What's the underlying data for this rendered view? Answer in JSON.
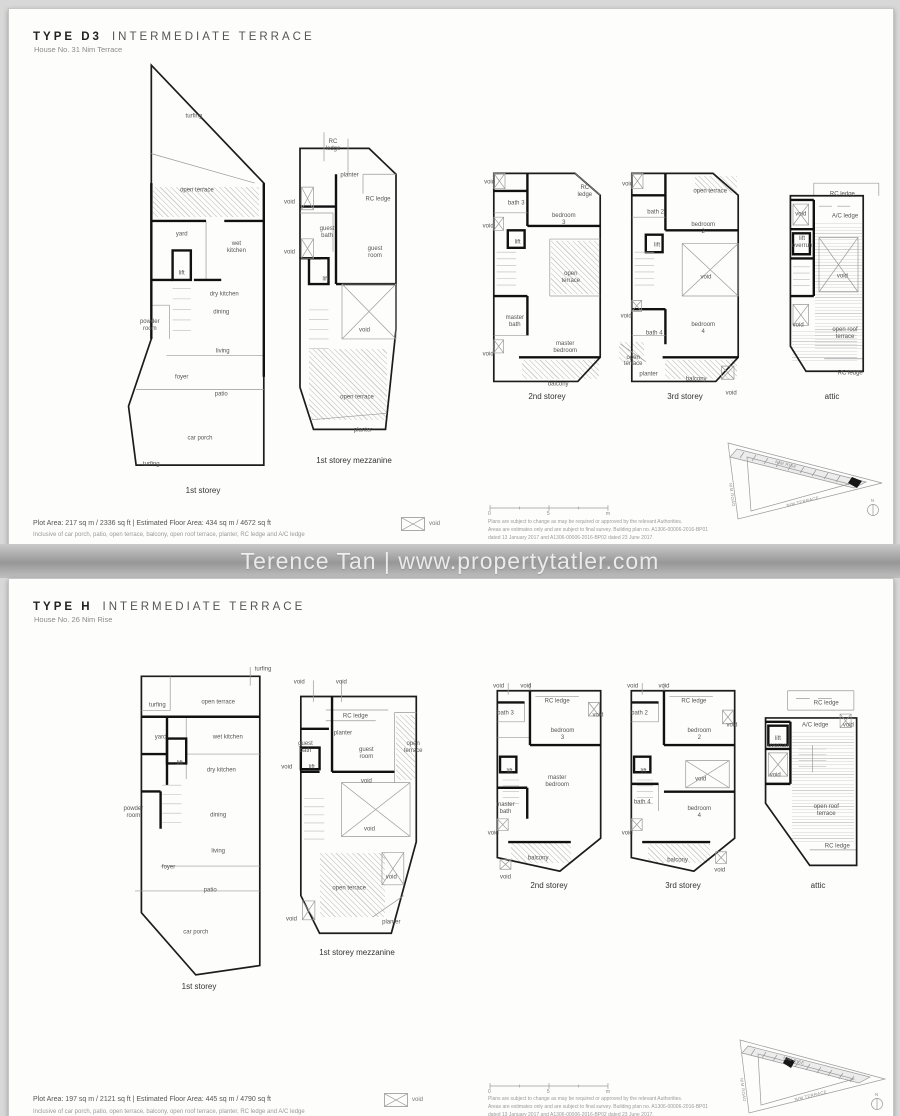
{
  "watermark": "Terence Tan | www.propertytatler.com",
  "legend": {
    "void_label": "void"
  },
  "scalebar": {
    "ticks": [
      "0",
      "5",
      "m"
    ]
  },
  "site_key": {
    "roads": [
      "NIM RISE",
      "NIM ROAD",
      "NIM TERRACE"
    ],
    "north": "N"
  },
  "disclaimer_lines": [
    "Plans are subject to change as may be required or approved by the relevant Authorities.",
    "Areas are estimates only and are subject to final survey. Building plan no. A1306-00006-2016-BP01",
    "dated 13 January 2017 and A1306-00006-2016-BP02 dated 23 June 2017."
  ],
  "pages": [
    {
      "type_label": "TYPE D3",
      "type_desc": "INTERMEDIATE TERRACE",
      "house_no": "House No. 31 Nim Terrace",
      "area_line": "Plot Area: 217 sq m / 2336 sq ft   |   Estimated Floor Area: 434 sq m / 4672 sq ft",
      "area_note": "Inclusive of car porch, patio, open terrace, balcony, open roof terrace, planter, RC ledge and A/C ledge",
      "plans": [
        {
          "caption": "1st storey",
          "labels": [
            {
              "t": "turfing",
              "x": 44,
              "y": 13
            },
            {
              "t": "open terrace",
              "x": 46,
              "y": 30,
              "w": 46
            },
            {
              "t": "yard",
              "x": 36,
              "y": 40
            },
            {
              "t": "wet kitchen",
              "x": 72,
              "y": 43,
              "w": 26
            },
            {
              "t": "lift",
              "x": 36,
              "y": 49
            },
            {
              "t": "dry kitchen",
              "x": 64,
              "y": 54,
              "w": 44
            },
            {
              "t": "powder room",
              "x": 15,
              "y": 61,
              "w": 28
            },
            {
              "t": "dining",
              "x": 62,
              "y": 58
            },
            {
              "t": "living",
              "x": 63,
              "y": 67
            },
            {
              "t": "foyer",
              "x": 36,
              "y": 73
            },
            {
              "t": "patio",
              "x": 62,
              "y": 77
            },
            {
              "t": "car porch",
              "x": 48,
              "y": 87,
              "w": 34
            },
            {
              "t": "turfing",
              "x": 16,
              "y": 93
            }
          ]
        },
        {
          "caption": "1st storey mezzanine",
          "labels": [
            {
              "t": "RC ledge",
              "x": 36,
              "y": 5,
              "w": 24
            },
            {
              "t": "planter",
              "x": 47,
              "y": 14
            },
            {
              "t": "void",
              "x": 7,
              "y": 22
            },
            {
              "t": "RC ledge",
              "x": 66,
              "y": 21,
              "w": 30
            },
            {
              "t": "guest bath",
              "x": 32,
              "y": 31,
              "w": 24
            },
            {
              "t": "void",
              "x": 7,
              "y": 37
            },
            {
              "t": "guest room",
              "x": 64,
              "y": 37,
              "w": 26
            },
            {
              "t": "lift",
              "x": 31,
              "y": 45
            },
            {
              "t": "void",
              "x": 57,
              "y": 60
            },
            {
              "t": "open terrace",
              "x": 52,
              "y": 80,
              "w": 44
            },
            {
              "t": "planter",
              "x": 56,
              "y": 90
            }
          ]
        },
        {
          "caption": "2nd storey",
          "labels": [
            {
              "t": "void",
              "x": 9,
              "y": 6
            },
            {
              "t": "bath 3",
              "x": 28,
              "y": 15,
              "w": 20
            },
            {
              "t": "RC ledge",
              "x": 77,
              "y": 10,
              "w": 24
            },
            {
              "t": "bedroom 3",
              "x": 62,
              "y": 22,
              "w": 28
            },
            {
              "t": "void",
              "x": 8,
              "y": 25
            },
            {
              "t": "lift",
              "x": 29,
              "y": 32
            },
            {
              "t": "open terrace",
              "x": 67,
              "y": 47,
              "w": 28
            },
            {
              "t": "master bath",
              "x": 27,
              "y": 66,
              "w": 26
            },
            {
              "t": "void",
              "x": 8,
              "y": 80
            },
            {
              "t": "master bedroom",
              "x": 63,
              "y": 77,
              "w": 32
            },
            {
              "t": "balcony",
              "x": 58,
              "y": 93
            }
          ]
        },
        {
          "caption": "3rd storey",
          "labels": [
            {
              "t": "void",
              "x": 9,
              "y": 7
            },
            {
              "t": "open terrace",
              "x": 68,
              "y": 10,
              "w": 38
            },
            {
              "t": "bath 2",
              "x": 29,
              "y": 19,
              "w": 20
            },
            {
              "t": "bedroom 2",
              "x": 63,
              "y": 26,
              "w": 28
            },
            {
              "t": "lift",
              "x": 30,
              "y": 33
            },
            {
              "t": "void",
              "x": 65,
              "y": 47
            },
            {
              "t": "void",
              "x": 8,
              "y": 64
            },
            {
              "t": "bath 4",
              "x": 28,
              "y": 71,
              "w": 20
            },
            {
              "t": "bedroom 4",
              "x": 63,
              "y": 69,
              "w": 28
            },
            {
              "t": "open terrace",
              "x": 13,
              "y": 83,
              "w": 22
            },
            {
              "t": "planter",
              "x": 24,
              "y": 89
            },
            {
              "t": "balcony",
              "x": 58,
              "y": 91
            },
            {
              "t": "void",
              "x": 83,
              "y": 97
            }
          ]
        },
        {
          "caption": "attic",
          "labels": [
            {
              "t": "RC ledge",
              "x": 58,
              "y": 7,
              "w": 30
            },
            {
              "t": "void",
              "x": 26,
              "y": 16
            },
            {
              "t": "A/C ledge",
              "x": 60,
              "y": 17,
              "w": 40
            },
            {
              "t": "lift overrun",
              "x": 27,
              "y": 29,
              "w": 22
            },
            {
              "t": "void",
              "x": 58,
              "y": 44
            },
            {
              "t": "void",
              "x": 24,
              "y": 66
            },
            {
              "t": "open roof terrace",
              "x": 60,
              "y": 70,
              "w": 34
            },
            {
              "t": "RC ledge",
              "x": 64,
              "y": 88,
              "w": 30
            }
          ]
        }
      ]
    },
    {
      "type_label": "TYPE H",
      "type_desc": "INTERMEDIATE TERRACE",
      "house_no": "House No. 26 Nim Rise",
      "area_line": "Plot Area: 197 sq m / 2121 sq ft   |   Estimated Floor Area: 445 sq m / 4790 sq ft",
      "area_note": "Inclusive of car porch, patio, open terrace, balcony, open roof terrace, planter, RC ledge and A/C ledge",
      "plans": [
        {
          "caption": "1st storey",
          "labels": [
            {
              "t": "turfing",
              "x": 90,
              "y": 1
            },
            {
              "t": "turfing",
              "x": 24,
              "y": 12
            },
            {
              "t": "open terrace",
              "x": 62,
              "y": 11,
              "w": 46
            },
            {
              "t": "yard",
              "x": 26,
              "y": 22
            },
            {
              "t": "wet kitchen",
              "x": 68,
              "y": 22,
              "w": 44
            },
            {
              "t": "lift",
              "x": 38,
              "y": 30
            },
            {
              "t": "dry kitchen",
              "x": 64,
              "y": 32,
              "w": 44
            },
            {
              "t": "powder room",
              "x": 9,
              "y": 45,
              "w": 26
            },
            {
              "t": "dining",
              "x": 62,
              "y": 46
            },
            {
              "t": "living",
              "x": 62,
              "y": 57
            },
            {
              "t": "foyer",
              "x": 31,
              "y": 62
            },
            {
              "t": "patio",
              "x": 57,
              "y": 69
            },
            {
              "t": "car porch",
              "x": 48,
              "y": 82,
              "w": 34
            }
          ]
        },
        {
          "caption": "1st storey mezzanine",
          "labels": [
            {
              "t": "void",
              "x": 13,
              "y": 3
            },
            {
              "t": "void",
              "x": 40,
              "y": 3
            },
            {
              "t": "RC ledge",
              "x": 49,
              "y": 15,
              "w": 30
            },
            {
              "t": "planter",
              "x": 41,
              "y": 21
            },
            {
              "t": "guest bath",
              "x": 17,
              "y": 26,
              "w": 24
            },
            {
              "t": "guest room",
              "x": 56,
              "y": 28,
              "w": 26
            },
            {
              "t": "open terrace",
              "x": 86,
              "y": 26,
              "w": 22
            },
            {
              "t": "void",
              "x": 5,
              "y": 33
            },
            {
              "t": "lift",
              "x": 21,
              "y": 33
            },
            {
              "t": "void",
              "x": 56,
              "y": 38
            },
            {
              "t": "void",
              "x": 58,
              "y": 55
            },
            {
              "t": "open terrace",
              "x": 45,
              "y": 76,
              "w": 44
            },
            {
              "t": "void",
              "x": 72,
              "y": 72
            },
            {
              "t": "planter",
              "x": 72,
              "y": 88
            },
            {
              "t": "void",
              "x": 8,
              "y": 87
            }
          ]
        },
        {
          "caption": "2nd storey",
          "labels": [
            {
              "t": "void",
              "x": 13,
              "y": 2
            },
            {
              "t": "void",
              "x": 33,
              "y": 2
            },
            {
              "t": "bath 3",
              "x": 18,
              "y": 15,
              "w": 20
            },
            {
              "t": "RC ledge",
              "x": 56,
              "y": 9,
              "w": 26
            },
            {
              "t": "bedroom 3",
              "x": 60,
              "y": 25,
              "w": 28
            },
            {
              "t": "void",
              "x": 86,
              "y": 16
            },
            {
              "t": "lift",
              "x": 21,
              "y": 43
            },
            {
              "t": "master bedroom",
              "x": 56,
              "y": 48,
              "w": 32
            },
            {
              "t": "master bath",
              "x": 18,
              "y": 61,
              "w": 26
            },
            {
              "t": "void",
              "x": 9,
              "y": 73
            },
            {
              "t": "balcony",
              "x": 42,
              "y": 85
            },
            {
              "t": "void",
              "x": 18,
              "y": 94
            }
          ]
        },
        {
          "caption": "3rd storey",
          "labels": [
            {
              "t": "void",
              "x": 13,
              "y": 2
            },
            {
              "t": "void",
              "x": 36,
              "y": 2
            },
            {
              "t": "bath 2",
              "x": 18,
              "y": 15,
              "w": 20
            },
            {
              "t": "RC ledge",
              "x": 58,
              "y": 9,
              "w": 26
            },
            {
              "t": "bedroom 2",
              "x": 62,
              "y": 25,
              "w": 28
            },
            {
              "t": "void",
              "x": 86,
              "y": 21
            },
            {
              "t": "lift",
              "x": 21,
              "y": 43
            },
            {
              "t": "void",
              "x": 63,
              "y": 47
            },
            {
              "t": "bath 4",
              "x": 20,
              "y": 58,
              "w": 20
            },
            {
              "t": "bedroom 4",
              "x": 62,
              "y": 63,
              "w": 28
            },
            {
              "t": "void",
              "x": 9,
              "y": 73
            },
            {
              "t": "balcony",
              "x": 46,
              "y": 86
            },
            {
              "t": "void",
              "x": 77,
              "y": 91
            }
          ]
        },
        {
          "caption": "attic",
          "labels": [
            {
              "t": "RC ledge",
              "x": 56,
              "y": 10,
              "w": 30
            },
            {
              "t": "A/C ledge",
              "x": 48,
              "y": 21,
              "w": 40
            },
            {
              "t": "void",
              "x": 72,
              "y": 21
            },
            {
              "t": "lift overrun",
              "x": 21,
              "y": 29,
              "w": 24
            },
            {
              "t": "void",
              "x": 19,
              "y": 45
            },
            {
              "t": "open roof terrace",
              "x": 56,
              "y": 62,
              "w": 40
            },
            {
              "t": "RC ledge",
              "x": 64,
              "y": 79,
              "w": 30
            }
          ]
        }
      ]
    }
  ]
}
